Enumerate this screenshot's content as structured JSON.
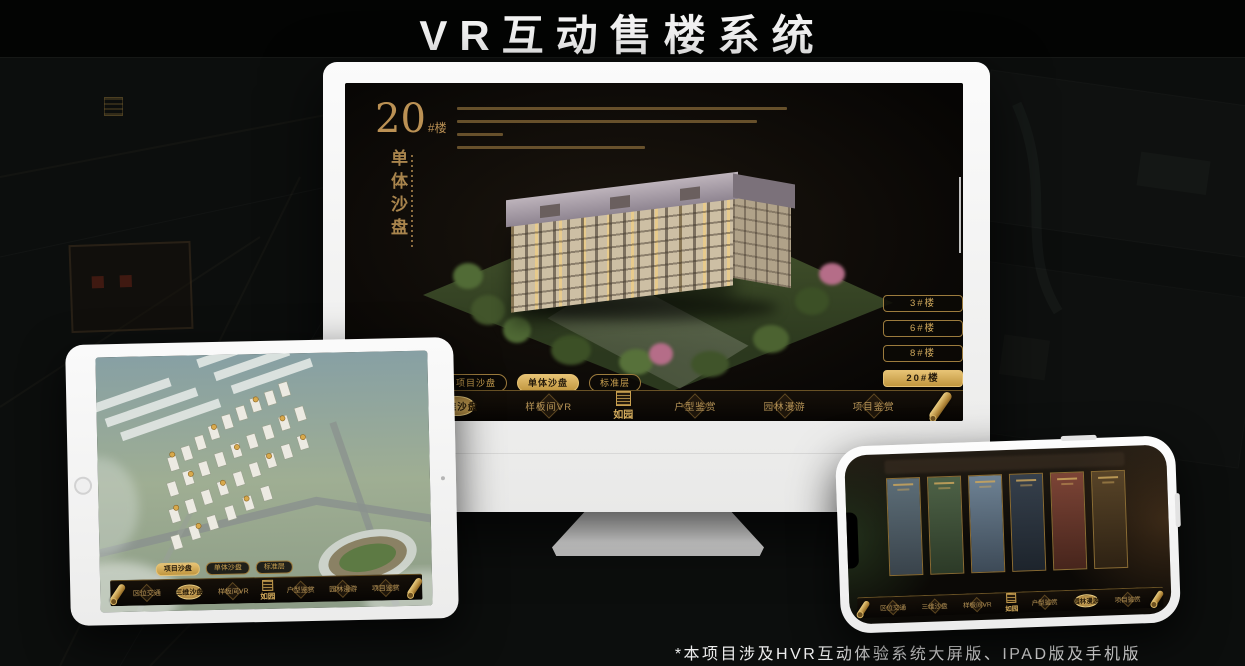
{
  "page": {
    "title": "VR互动售楼系统",
    "footnote": "*本项目涉及HVR互动体验系统大屏版、IPAD版及手机版"
  },
  "brand": {
    "logo_text": "如园"
  },
  "colors": {
    "accent_gold": "#c9a050",
    "active_gold": "#d9b45c",
    "device_white": "#f5f5f4",
    "app_background": "#0e0b08",
    "title_white": "#f2f2f2"
  },
  "monitor": {
    "heading": {
      "number": "20",
      "suffix": "#楼",
      "subtitle": "单体沙盘"
    },
    "building_buttons": [
      {
        "label": "3#楼",
        "active": false
      },
      {
        "label": "6#楼",
        "active": false
      },
      {
        "label": "8#楼",
        "active": false
      },
      {
        "label": "20#楼",
        "active": true
      }
    ],
    "view_tabs": [
      {
        "label": "项目沙盘",
        "active": false
      },
      {
        "label": "单体沙盘",
        "active": true
      },
      {
        "label": "标准层",
        "active": false
      }
    ],
    "nav": {
      "items": [
        {
          "label": "区位交通",
          "active": false
        },
        {
          "label": "三维沙盘",
          "active": true
        },
        {
          "label": "样板间VR",
          "active": false
        },
        {
          "label": "户型鉴赏",
          "active": false
        },
        {
          "label": "园林漫游",
          "active": false
        },
        {
          "label": "项目鉴赏",
          "active": false
        }
      ]
    }
  },
  "tablet": {
    "view_tabs": [
      {
        "label": "项目沙盘",
        "active": true
      },
      {
        "label": "单体沙盘",
        "active": false
      },
      {
        "label": "标准层",
        "active": false
      }
    ],
    "nav": {
      "items": [
        {
          "label": "区位交通",
          "active": false
        },
        {
          "label": "三维沙盘",
          "active": true
        },
        {
          "label": "样板间VR",
          "active": false
        },
        {
          "label": "户型鉴赏",
          "active": false
        },
        {
          "label": "园林漫游",
          "active": false
        },
        {
          "label": "项目鉴赏",
          "active": false
        }
      ]
    }
  },
  "phone": {
    "nav": {
      "items": [
        {
          "label": "区位交通",
          "active": false
        },
        {
          "label": "三维沙盘",
          "active": false
        },
        {
          "label": "样板间VR",
          "active": false
        },
        {
          "label": "户型鉴赏",
          "active": false
        },
        {
          "label": "园林漫游",
          "active": true
        },
        {
          "label": "项目鉴赏",
          "active": false
        }
      ]
    }
  }
}
